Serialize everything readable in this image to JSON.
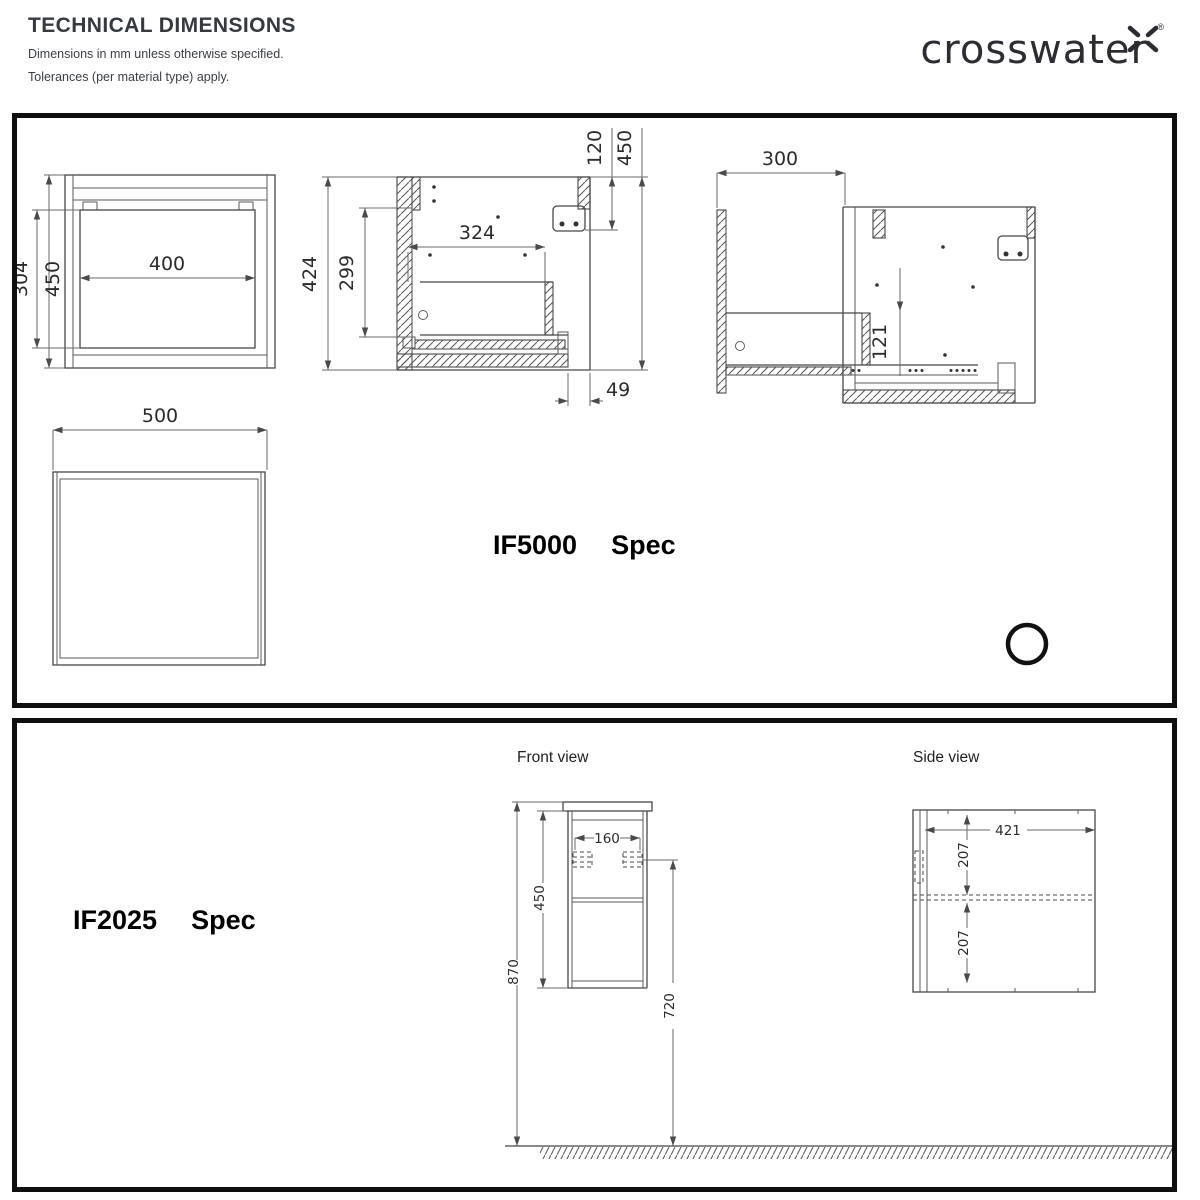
{
  "header": {
    "title": "TECHNICAL DIMENSIONS",
    "line1": "Dimensions in mm unless otherwise specified.",
    "line2": "Tolerances (per material type) apply.",
    "brand": "crosswater",
    "registered": "®"
  },
  "colors": {
    "ink": "#343a40",
    "line": "#474747",
    "border": "#0f0f0f"
  },
  "if5000": {
    "model": "IF5000",
    "spec": "Spec",
    "front": {
      "opening_width": "400",
      "opening_height": "304",
      "height": "450"
    },
    "section": {
      "height": "424",
      "drawer_height": "299",
      "drawer_width": "324",
      "top_gap": "120",
      "overall_height": "450",
      "front_offset": "49"
    },
    "open": {
      "extension": "300",
      "drop": "121"
    },
    "top": {
      "width": "500"
    }
  },
  "if2025": {
    "model": "IF2025",
    "spec": "Spec",
    "front_label": "Front view",
    "side_label": "Side view",
    "front": {
      "bracket_spacing": "160",
      "cabinet_height": "450",
      "total_height": "870",
      "bracket_to_floor": "720"
    },
    "side": {
      "depth": "421",
      "upper_section": "207",
      "lower_section": "207"
    }
  }
}
